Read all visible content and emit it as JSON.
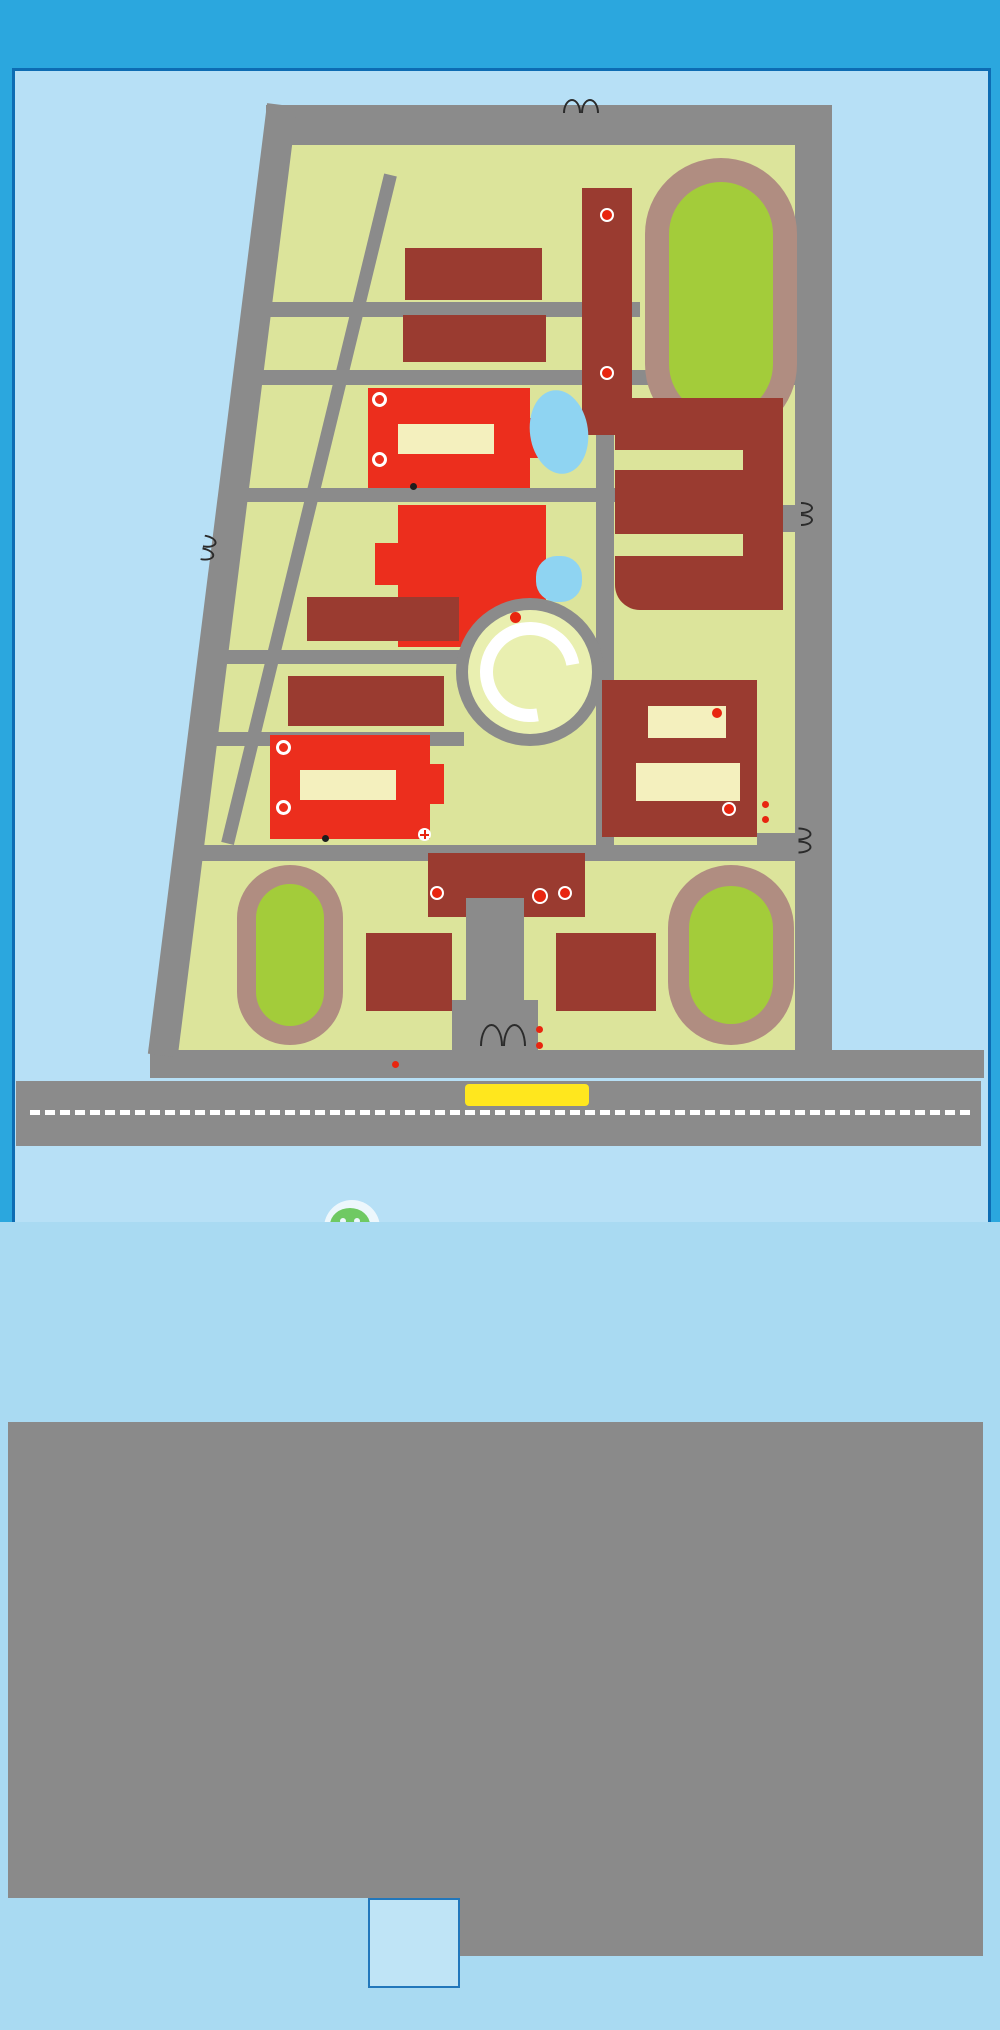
{
  "title": "南阳市第一完全学校考点平面图",
  "notice": "（本考点实行视频监控，特此提醒！）",
  "west_mark": "西",
  "colors": {
    "page_blue": "#2BA7DE",
    "panel_blue": "#B7E0F6",
    "lower_blue": "#A9DAF2",
    "ground": "#DCE49B",
    "road_gray": "#8B8B8B",
    "dark_building": "#9A3B30",
    "red_building": "#EC2E1D",
    "label_yellow": "#FFD40A",
    "navy": "#1E3C8C",
    "gate_red": "#E60012",
    "cell_pale": "#FBF5C9",
    "cell_highlight": "#FFE30A",
    "toilet_green": "#9CCA3E",
    "floor_text": "#B5502F",
    "track": "#B08D81",
    "infield": "#A3CC3A",
    "water": "#8FD4F2",
    "watermark_green": "#57C232"
  },
  "map": {
    "caption": "总平面图",
    "watermark": "南阳家长汇",
    "gates": {
      "north": "北大门",
      "south": "南大门",
      "east": "东大门",
      "west": "西大门",
      "kg": "幼儿园大门"
    },
    "entrances": {
      "south": "01-36考场入口",
      "east": "37-72考场入口"
    },
    "ring_road": [
      "区",
      "间",
      "道"
    ],
    "main_road": [
      "中",
      "州",
      "西",
      "路"
    ],
    "buildings": {
      "hs_boys_dorm": "高中男生宿舍楼",
      "hs_girls_dorm": "高中女生宿舍楼",
      "hs_teach": "高中教学楼",
      "hs_rooms": "37-72考场",
      "lecture": "报告厅",
      "lecture_rooms": [
        "考务办公室",
        "考场指挥室",
        "试卷分发室",
        "保密室"
      ],
      "water": "景观水系",
      "kindergarten": "幼儿园",
      "ms_girls_dorm": "初中女生宿舍楼",
      "ms_boys_dorm": "初中男生宿舍楼",
      "share": "共享中心",
      "ms_teach": "初中教学楼",
      "ms_rooms": "01-36考场",
      "primary": "小学教学楼",
      "office": "办公楼",
      "swim": "游泳馆",
      "basket": "篮球馆",
      "sports": "运动场"
    },
    "notes": {
      "wc": "WC",
      "tea": "茶水供应处",
      "health": "卫生防疫室",
      "video": "视频监控室",
      "broadcast": "广播室",
      "police": "公安警务室",
      "consult": "咨询处",
      "temp": "体温异常休息处"
    }
  },
  "floorplan": {
    "caption": "考场平面图",
    "spare": "备用考场",
    "labels": {
      "stairs": "楼梯",
      "corridor": "连廊",
      "female": "女厕",
      "male": "男厕"
    },
    "floors": [
      "六层",
      "五层",
      "四层",
      "三层",
      "二层",
      "一层"
    ],
    "junior": {
      "name": "初中部",
      "ghost": "初中部教学楼",
      "top_rows": [
        [
          null,
          null,
          null,
          null,
          null
        ],
        [
          null,
          "第36考场",
          "第35考场",
          "第34考场",
          "第33考场"
        ],
        [
          null,
          "第32考场",
          "第31考场",
          "第30考场",
          "第29考场"
        ],
        [
          null,
          "第28考场",
          "第27考场",
          "第26考场",
          "第25考场"
        ],
        [
          null,
          "第24考场",
          "第23考场",
          "第22考场",
          "第21考场"
        ],
        [
          null,
          null,
          null,
          null,
          null
        ]
      ],
      "bottom_rows": [
        [
          null,
          null,
          null,
          null,
          null
        ],
        [
          null,
          "第20考场",
          "第19考场",
          "第18考场",
          null
        ],
        [
          "第17考场",
          "第16考场",
          "第15考场",
          "第14考场",
          "第13考场"
        ],
        [
          "备用考场",
          "第12考场",
          "第11考场",
          "第10考场",
          "第09考场"
        ],
        [
          null,
          "第08考场",
          "第07考场",
          "第06考场",
          "第05考场"
        ],
        [
          null,
          "第04考场",
          "第03考场",
          "第02考场",
          "第01考场"
        ]
      ]
    },
    "senior": {
      "name": "高中部",
      "ghost": "高中部教学楼",
      "top_rows": [
        [
          null,
          null,
          null,
          null,
          null
        ],
        [
          null,
          null,
          null,
          null,
          null
        ],
        [
          "备用考场",
          null,
          null,
          "第72考场",
          "第71考场"
        ],
        [
          "第70考场",
          "第69考场",
          "第68考场",
          "第67考场",
          "第66考场"
        ],
        [
          null,
          "第65考场",
          "第64考场",
          "第63考场",
          "第62考场"
        ],
        [
          null,
          null,
          null,
          null,
          null
        ]
      ],
      "bottom_rows": [
        [
          null,
          null,
          null,
          null,
          null
        ],
        [
          "第61考场",
          "第60考场",
          "第59考场",
          "第58考场",
          "第57考场"
        ],
        [
          "第56考场",
          "第55考场",
          "第54考场",
          "第53考场",
          "第52考场"
        ],
        [
          "第51考场",
          "第50考场",
          "第49考场",
          "第48考场",
          "第47考场"
        ],
        [
          "第46考场",
          "第45考场",
          "第44考场",
          "第43考场",
          "第42考场"
        ],
        [
          "第41考场",
          "第40考场",
          "第39考场",
          "第38考场",
          "第37考场"
        ]
      ]
    }
  }
}
